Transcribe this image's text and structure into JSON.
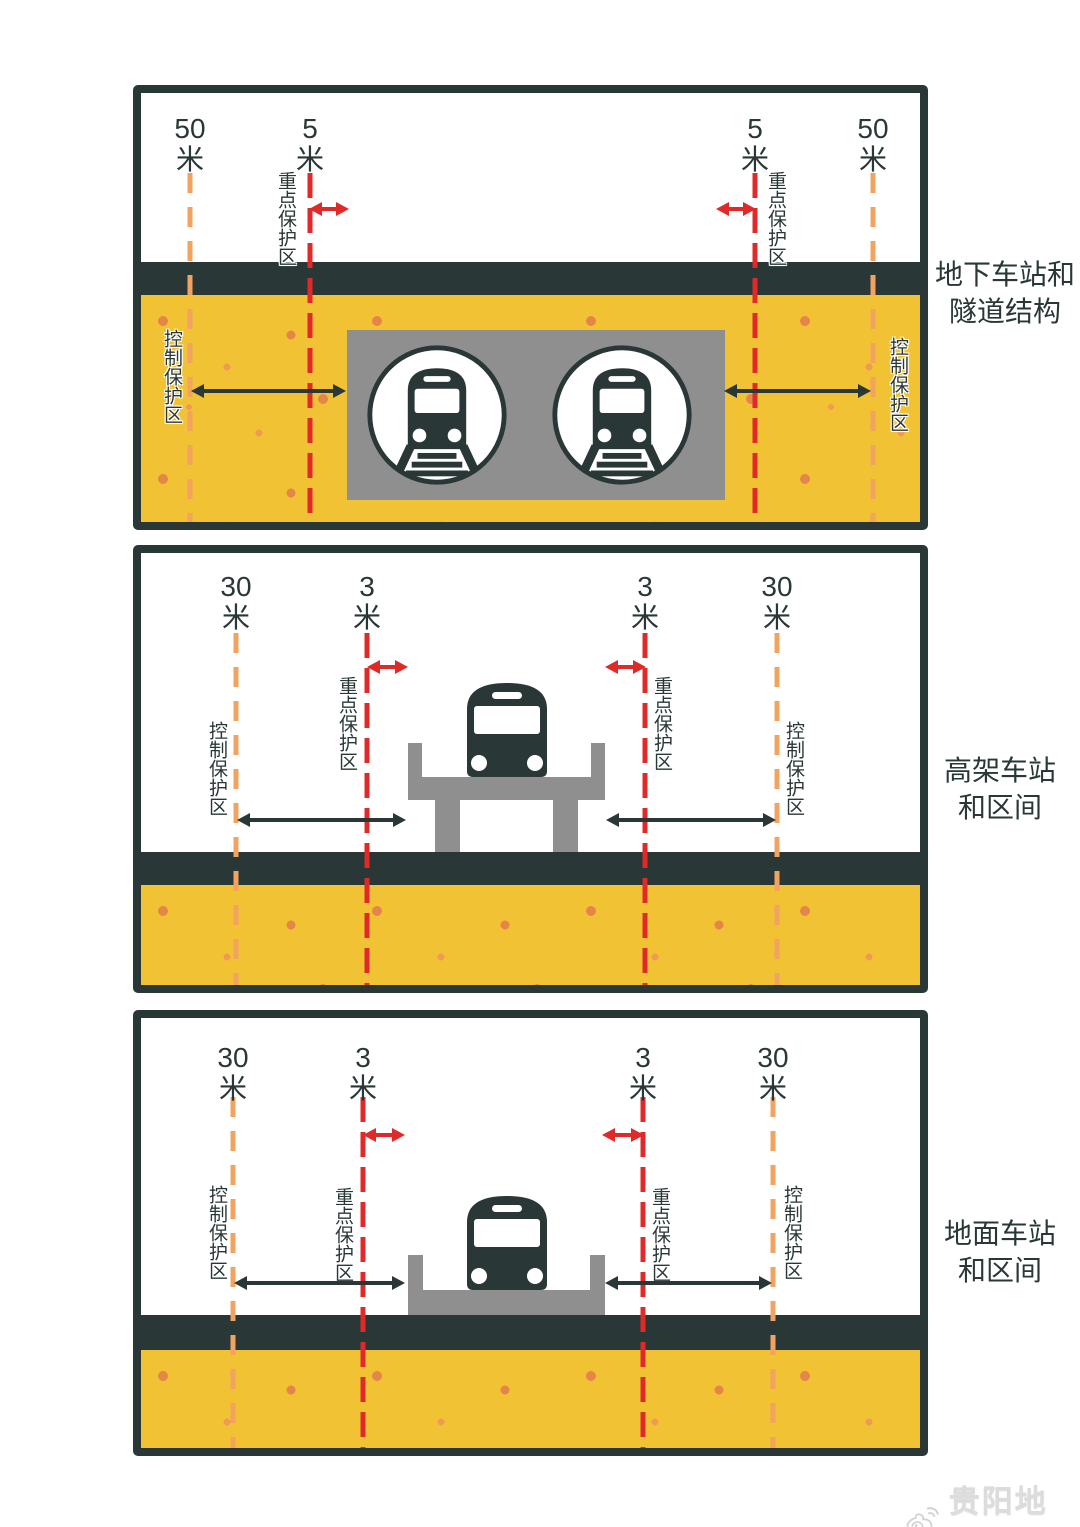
{
  "title": "地铁保护区示意图",
  "panels": [
    {
      "name": "underground",
      "caption": [
        "地下车站和",
        "隧道结构"
      ],
      "outer": {
        "value": "50",
        "unit": "米"
      },
      "inner": {
        "value": "5",
        "unit": "米"
      },
      "key_zone": "重点保护区",
      "control_zone": "控制保护区"
    },
    {
      "name": "elevated",
      "caption": [
        "高架车站",
        "和区间"
      ],
      "outer": {
        "value": "30",
        "unit": "米"
      },
      "inner": {
        "value": "3",
        "unit": "米"
      },
      "key_zone": "重点保护区",
      "control_zone": "控制保护区"
    },
    {
      "name": "ground",
      "caption": [
        "地面车站",
        "和区间"
      ],
      "outer": {
        "value": "30",
        "unit": "米"
      },
      "inner": {
        "value": "3",
        "unit": "米"
      },
      "key_zone": "重点保护区",
      "control_zone": "控制保护区"
    }
  ],
  "watermark": {
    "icon": "weibo-icon",
    "text": "贵阳地铁"
  },
  "colors": {
    "dark": "#2a3737",
    "yellow": "#f1c233",
    "dot": "#e5854a",
    "dot2": "#ef9a55",
    "red": "#e02a2a",
    "orange": "#f2a360",
    "gray": "#8f8f8f",
    "watermark": "#dcdcdc"
  }
}
